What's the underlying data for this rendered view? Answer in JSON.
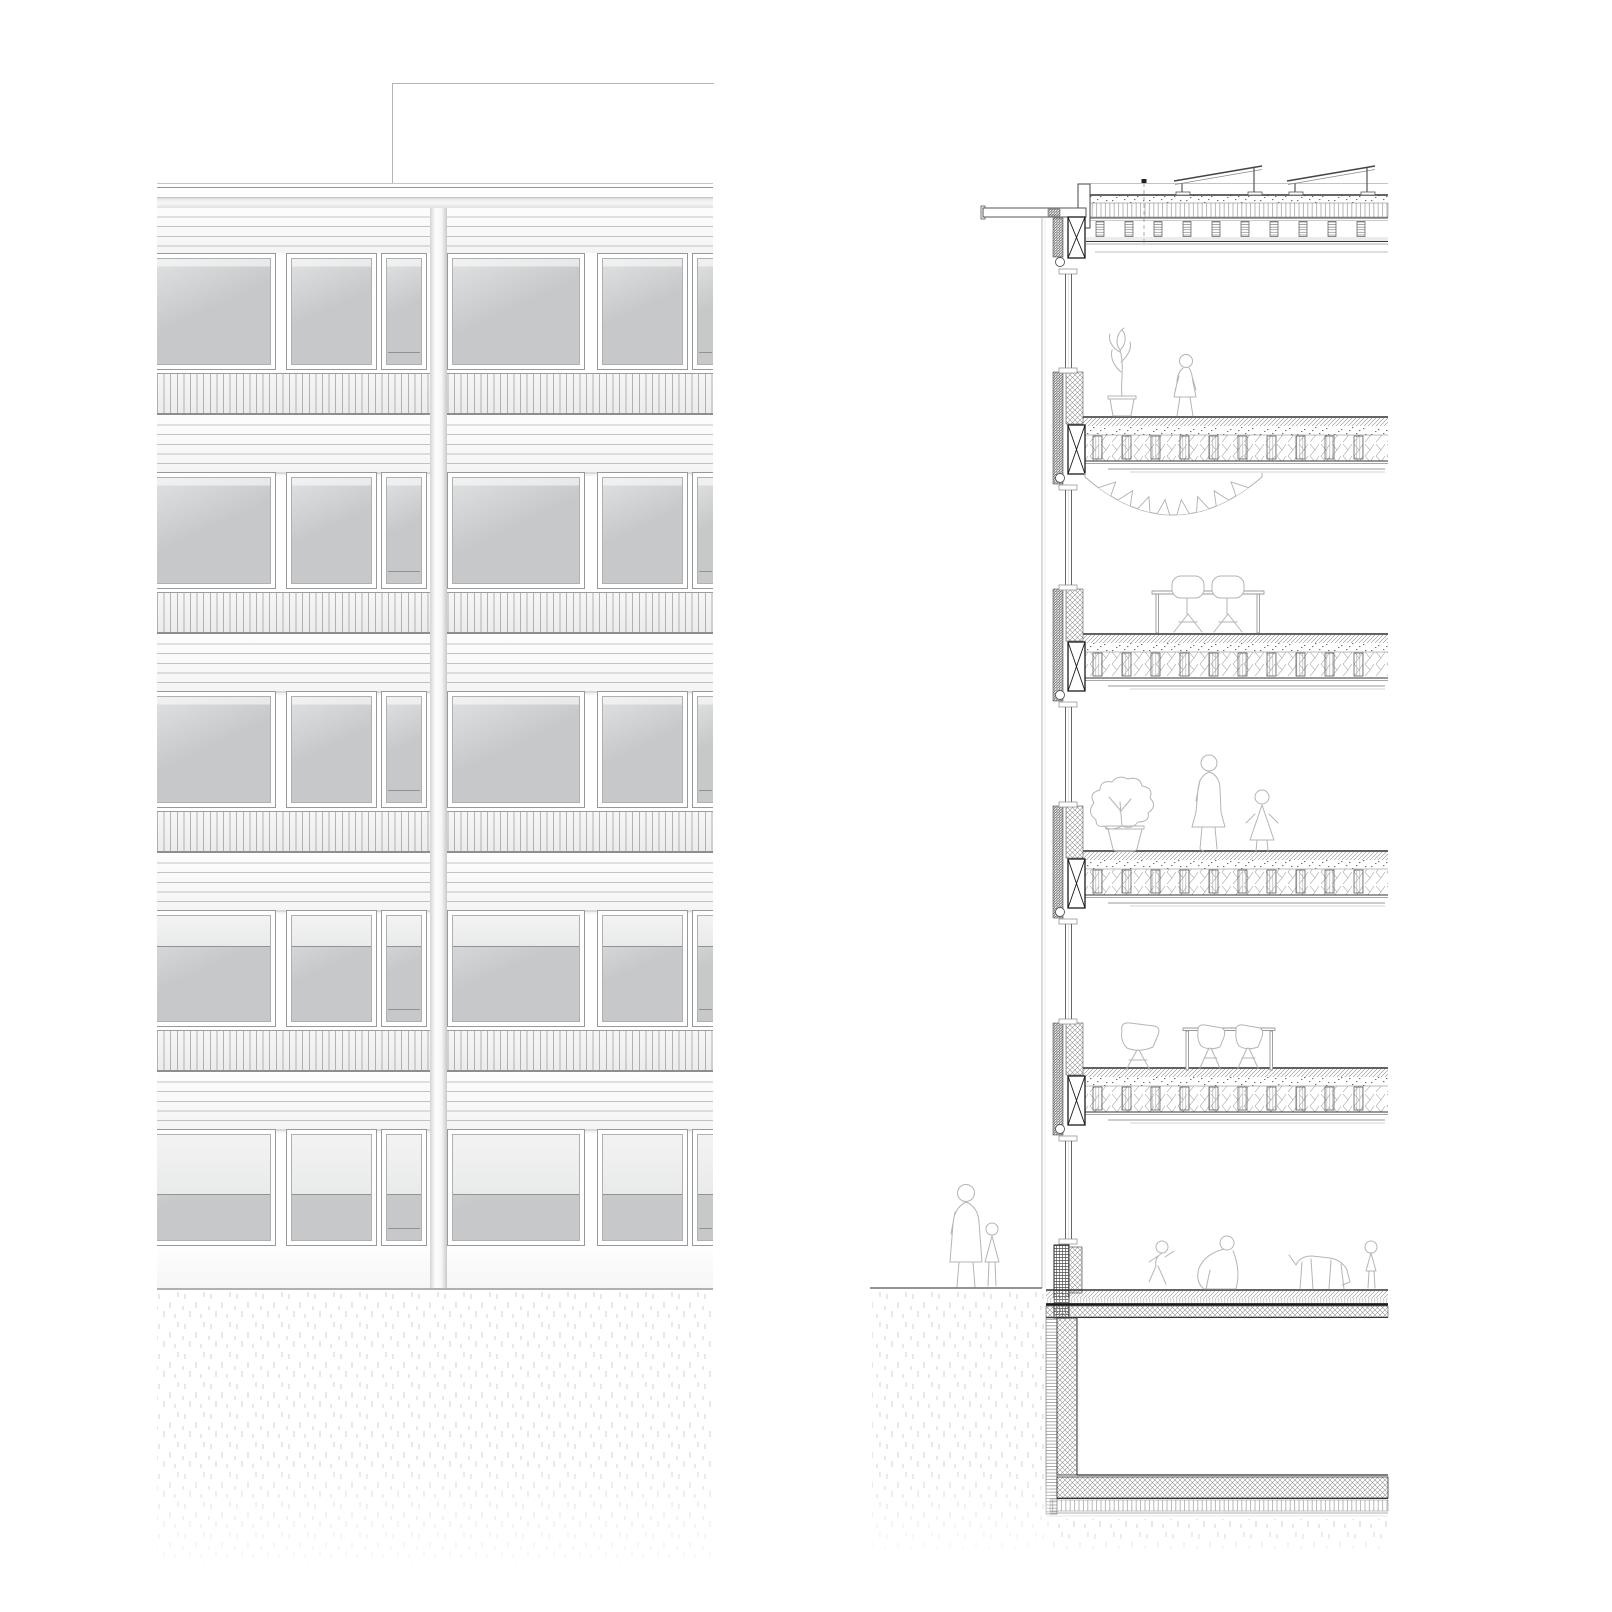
{
  "drawing": {
    "kind": "architectural line drawing",
    "panels": [
      {
        "id": "elevation",
        "label": "facade elevation"
      },
      {
        "id": "section",
        "label": "building cross section"
      }
    ]
  },
  "colors": {
    "paper": "#ffffff",
    "glass": "#c6c8ca",
    "blind": "#eeeeee",
    "line_dark": "#333333",
    "line_mid": "#777777",
    "line_light": "#b5b5b5",
    "stipple": "#d6d6d6"
  },
  "elevation": {
    "label": "facade elevation",
    "rooftop_box": true,
    "bays": 2,
    "windows_per_floor": 6,
    "floors": [
      {
        "label": "floor 5",
        "blind_ratio": 0
      },
      {
        "label": "floor 4",
        "blind_ratio": 0
      },
      {
        "label": "floor 3",
        "blind_ratio": 0
      },
      {
        "label": "floor 2",
        "blind_ratio": 0.26
      },
      {
        "label": "ground floor",
        "blind_ratio": 0.5
      }
    ]
  },
  "section": {
    "label": "building cross section",
    "roof": {
      "solar_panel_count": 2,
      "canopy": true,
      "parapet": true,
      "vent": true
    },
    "levels": [
      {
        "label": "level 4",
        "scene": "potted plant and walking figure"
      },
      {
        "label": "level 3",
        "scene": "pennant garland, dining table with two chairs"
      },
      {
        "label": "level 2",
        "scene": "potted plant, woman and child"
      },
      {
        "label": "level 1",
        "scene": "armchair and table with two chairs"
      },
      {
        "label": "ground level",
        "scene": "figures outside, playing children, crouching adult and dog inside"
      }
    ],
    "basement": {
      "label": "basement",
      "empty": true
    }
  }
}
